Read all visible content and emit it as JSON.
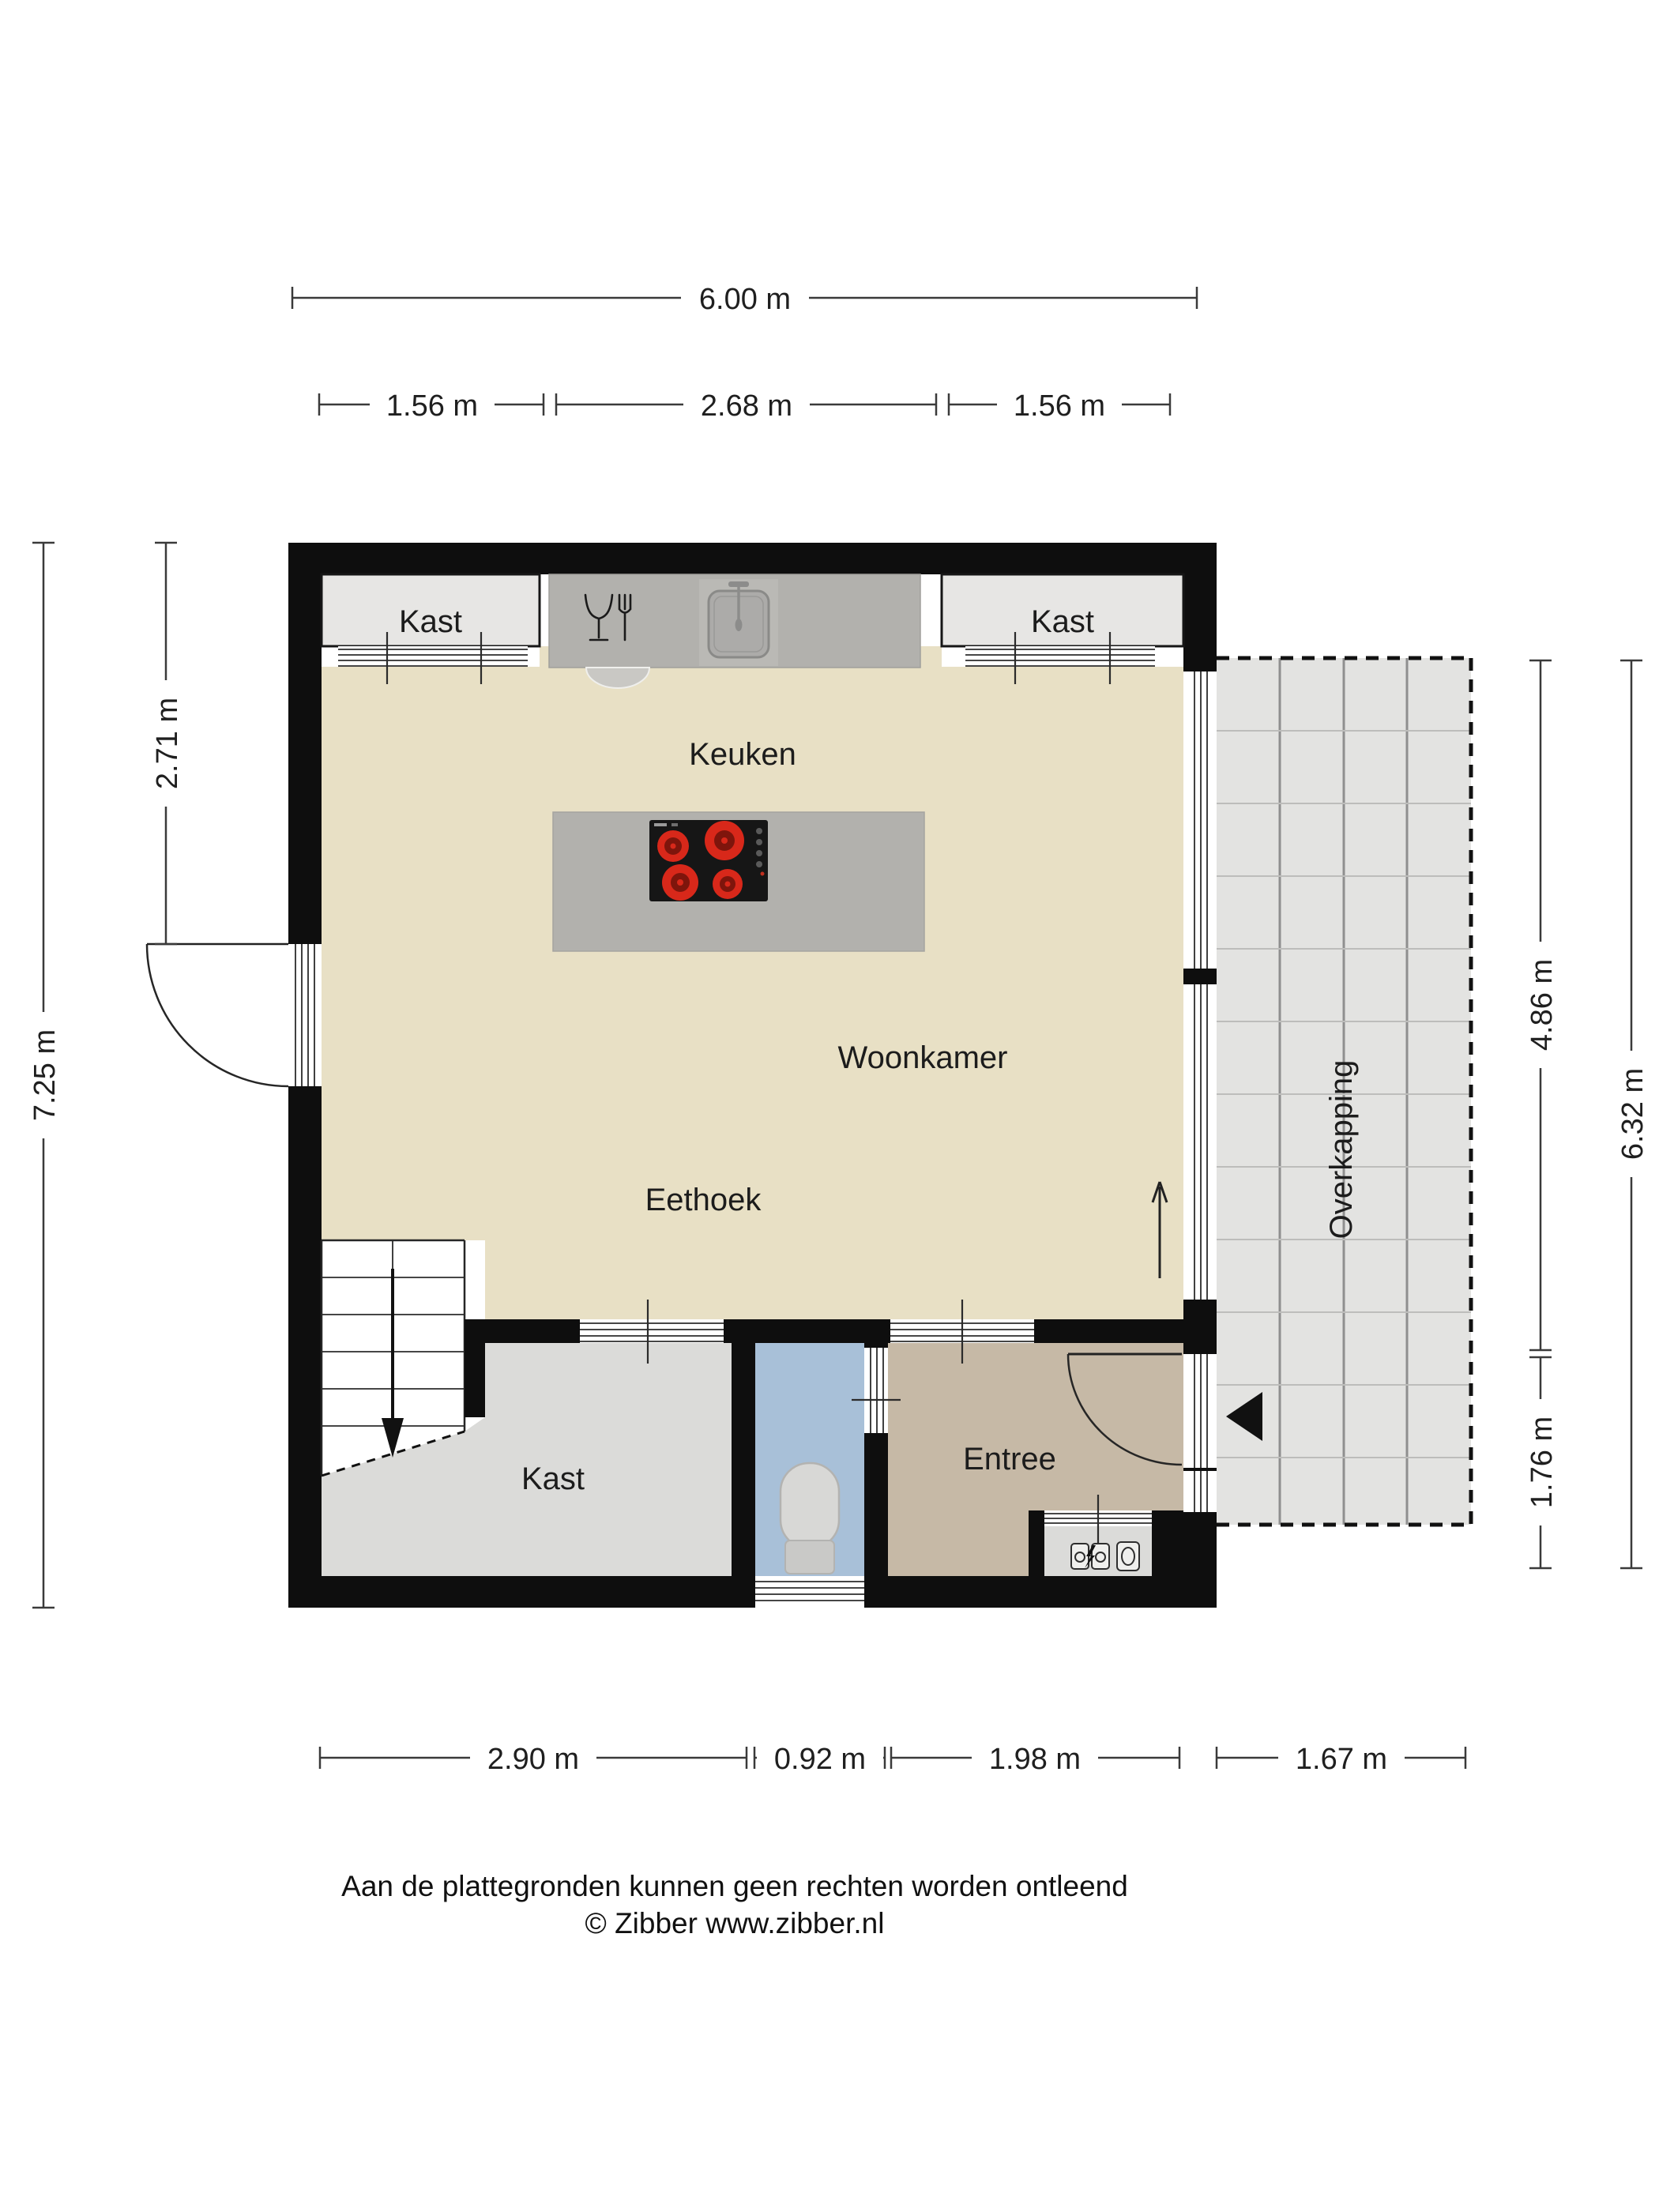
{
  "colors": {
    "wall": "#0e0e0e",
    "floor_main": "#e8e0c5",
    "floor_closet": "#dbdbd9",
    "floor_toilet": "#a8c0d8",
    "floor_entree": "#c6b9a6",
    "floor_overkapping": "#e3e3e1",
    "counter": "#b2b1ad",
    "burner_red": "#d8281a",
    "burner_dark": "#7e150c"
  },
  "rooms": {
    "kast_top_left": "Kast",
    "kast_top_right": "Kast",
    "keuken": "Keuken",
    "woonkamer": "Woonkamer",
    "eethoek": "Eethoek",
    "kast_bottom": "Kast",
    "entree": "Entree",
    "overkapping": "Overkapping"
  },
  "dimensions": {
    "top": {
      "total": "6.00 m",
      "segments": [
        "1.56 m",
        "2.68 m",
        "1.56 m"
      ]
    },
    "left": {
      "inner": "2.71 m",
      "total": "7.25 m"
    },
    "right": {
      "upper": "4.86 m",
      "lower": "1.76 m",
      "total": "6.32 m"
    },
    "bottom": {
      "segments": [
        "2.90 m",
        "0.92 m",
        "1.98 m",
        "1.67 m"
      ]
    }
  },
  "footer": {
    "disclaimer": "Aan de plattegronden kunnen geen rechten worden ontleend",
    "copyright": "© Zibber www.zibber.nl"
  }
}
